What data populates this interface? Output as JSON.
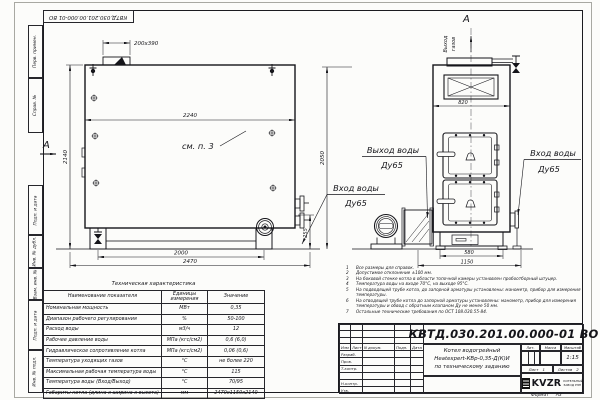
{
  "sheet": {
    "doc_number": "КВТД.030.201.00.000-01 ВО",
    "format_label": "Формат",
    "format_value": "А3"
  },
  "margin_stamps": [
    "Перв. примен.",
    "Справ. №",
    "Подп. и дата",
    "Инв. № дубл.",
    "Взам. инв. №",
    "Подп. и дата",
    "Инв. № подл."
  ],
  "front_view": {
    "section_letter": "А",
    "dim_hatch": "200x390",
    "dim_width_top": "2240",
    "dim_height": "2140",
    "see_note": "см. п. 3",
    "dim_base": "2000",
    "dim_length": "2470",
    "dim_flange_height": "255"
  },
  "side_view": {
    "section_letter": "А",
    "gas_outlet_word1": "Выход",
    "gas_outlet_word2": "газов",
    "dim_width": "820",
    "dim_height": "2050",
    "dim_base": "580",
    "dim_overall": "1150"
  },
  "pipe_labels": {
    "water_outlet_title": "Выход воды",
    "water_outlet_dn": "Ду65",
    "water_inlet_mid_title": "Вход воды",
    "water_inlet_mid_dn": "Ду65",
    "water_inlet_right_title": "Вход воды",
    "water_inlet_right_dn": "Ду65"
  },
  "notes": [
    {
      "n": "1",
      "text": "Все размеры для справок."
    },
    {
      "n": "2",
      "text": "Допустимое отклонение ±100 мм."
    },
    {
      "n": "3",
      "text": "На боковой стенке котла в области топочной камеры установлен пробоотборный штуцер."
    },
    {
      "n": "4",
      "text": "Температура воды на входе 70°С, на выходе 95°С."
    },
    {
      "n": "5",
      "text": "На подводящей трубе котла, до запорной арматуры установлены: манометр, прибор для измерения температуры."
    },
    {
      "n": "6",
      "text": "На отводящей трубе котла до запорной арматуры установлены: манометр, прибор для измерения температуры и обвод с обратным клапаном Ду не менее 50 мм."
    },
    {
      "n": "7",
      "text": "Остальные технические требования по ОСТ 108.030.55-84."
    }
  ],
  "tech_table": {
    "title": "Техническая характеристика",
    "col_name": "Наименование показателя",
    "col_units_1": "Единицы",
    "col_units_2": "измерения",
    "col_value": "Значение",
    "rows": [
      {
        "name": "Номинальная мощность",
        "units": "МВт",
        "value": "0,35"
      },
      {
        "name": "Диапазон рабочего регулирования",
        "units": "%",
        "value": "50-100"
      },
      {
        "name": "Расход воды",
        "units": "м3/ч",
        "value": "12"
      },
      {
        "name": "Рабочее давление воды",
        "units": "МПа (кгс/см2)",
        "value": "0,6 (6,0)"
      },
      {
        "name": "Гидравлическое сопротивление котла",
        "units": "МПа (кгс/см2)",
        "value": "0,06 (0,6)"
      },
      {
        "name": "Температура уходящих газов",
        "units": "°С",
        "value": "не более 220"
      },
      {
        "name": "Максимальная рабочая температура воды",
        "units": "°С",
        "value": "115"
      },
      {
        "name": "Температура воды (Вход/Выход)",
        "units": "°С",
        "value": "70/95"
      },
      {
        "name": "Габариты котла (длина х ширина х высота)",
        "units": "мм",
        "value": "2470х1150х2140"
      }
    ]
  },
  "title_block": {
    "doc_number": "КВТД.030.201.00.000-01 ВО",
    "col_izm": "Изм",
    "col_list": "Лист",
    "col_doc": "N докум.",
    "col_sign": "Подп.",
    "col_date": "Дата",
    "row_labels": [
      "Разраб.",
      "Пров.",
      "Т.контр.",
      "",
      "Н.контр.",
      "Утв."
    ],
    "product_line1": "Котел водогрейный",
    "product_line2": "Heatexpert-КВр-0,35-Д(К)И",
    "product_line3": "по техническому заданию",
    "lit_label": "Лит.",
    "mass_label": "Масса",
    "scale_label": "Масштаб",
    "scale_value": "1:15",
    "sheet_label": "Лист",
    "sheet_value": "1",
    "sheets_label": "Листов",
    "sheets_value": "2",
    "logo_text": "KVZR",
    "logo_sub1": "КОТЕЛЬНЫЙ",
    "logo_sub2": "ЗАВОД РЭП"
  }
}
